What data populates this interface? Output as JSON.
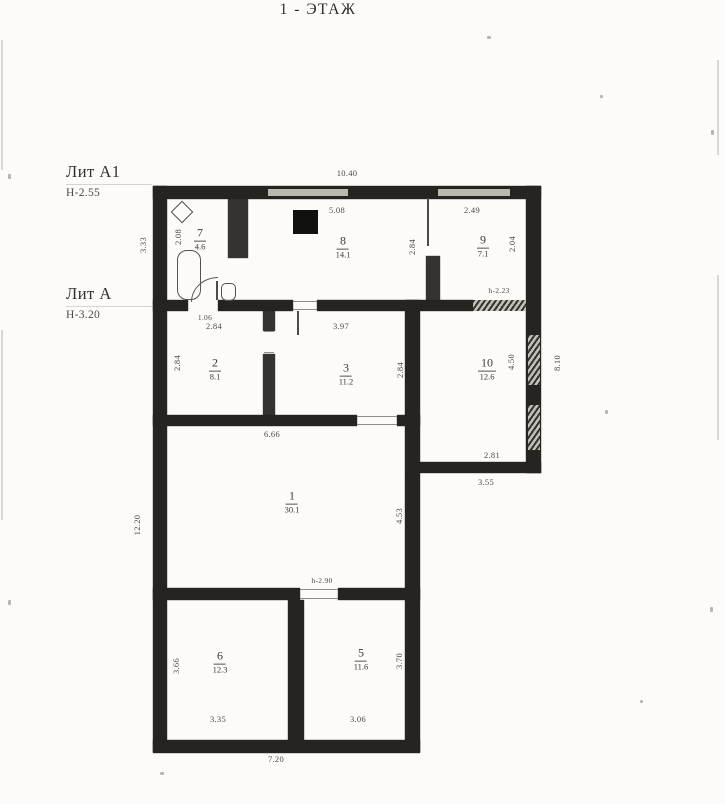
{
  "title": "1 - ЭТАЖ",
  "labels": {
    "lit_a1": {
      "name": "Лит А1",
      "height": "Н-2.55"
    },
    "lit_a": {
      "name": "Лит А",
      "height": "Н-3.20"
    }
  },
  "rooms": {
    "r7": {
      "number": "7",
      "area": "4.6"
    },
    "r8": {
      "number": "8",
      "area": "14.1"
    },
    "r9": {
      "number": "9",
      "area": "7.1"
    },
    "r2": {
      "number": "2",
      "area": "8.1"
    },
    "r3": {
      "number": "3",
      "area": "11.2"
    },
    "r10": {
      "number": "10",
      "area": "12.6"
    },
    "r1": {
      "number": "1",
      "area": "30.1"
    },
    "r6": {
      "number": "6",
      "area": "12.3"
    },
    "r5": {
      "number": "5",
      "area": "11.6"
    }
  },
  "dims": {
    "overall_top": "10.40",
    "annex_left": "3.33",
    "room7_width": "2.08",
    "room7_door": "1.06",
    "room8_top": "5.08",
    "room8_right": "2.84",
    "room9_top": "2.49",
    "room9_right": "2.04",
    "passage_height_right": "h-2.23",
    "room2_top": "2.84",
    "room2_left": "2.84",
    "room3_top": "3.97",
    "room3_right": "2.84",
    "room10_right": "4.50",
    "east_side": "8.10",
    "room10_bottom": "2.81",
    "annex10_bottom": "3.55",
    "room1_top": "6.66",
    "room1_right": "4.53",
    "west_side": "12.20",
    "passage_height_center": "h-2.90",
    "room6_left": "3.66",
    "room6_bottom": "3.35",
    "room5_right": "3.70",
    "room5_bottom": "3.06",
    "overall_bottom": "7.20"
  }
}
